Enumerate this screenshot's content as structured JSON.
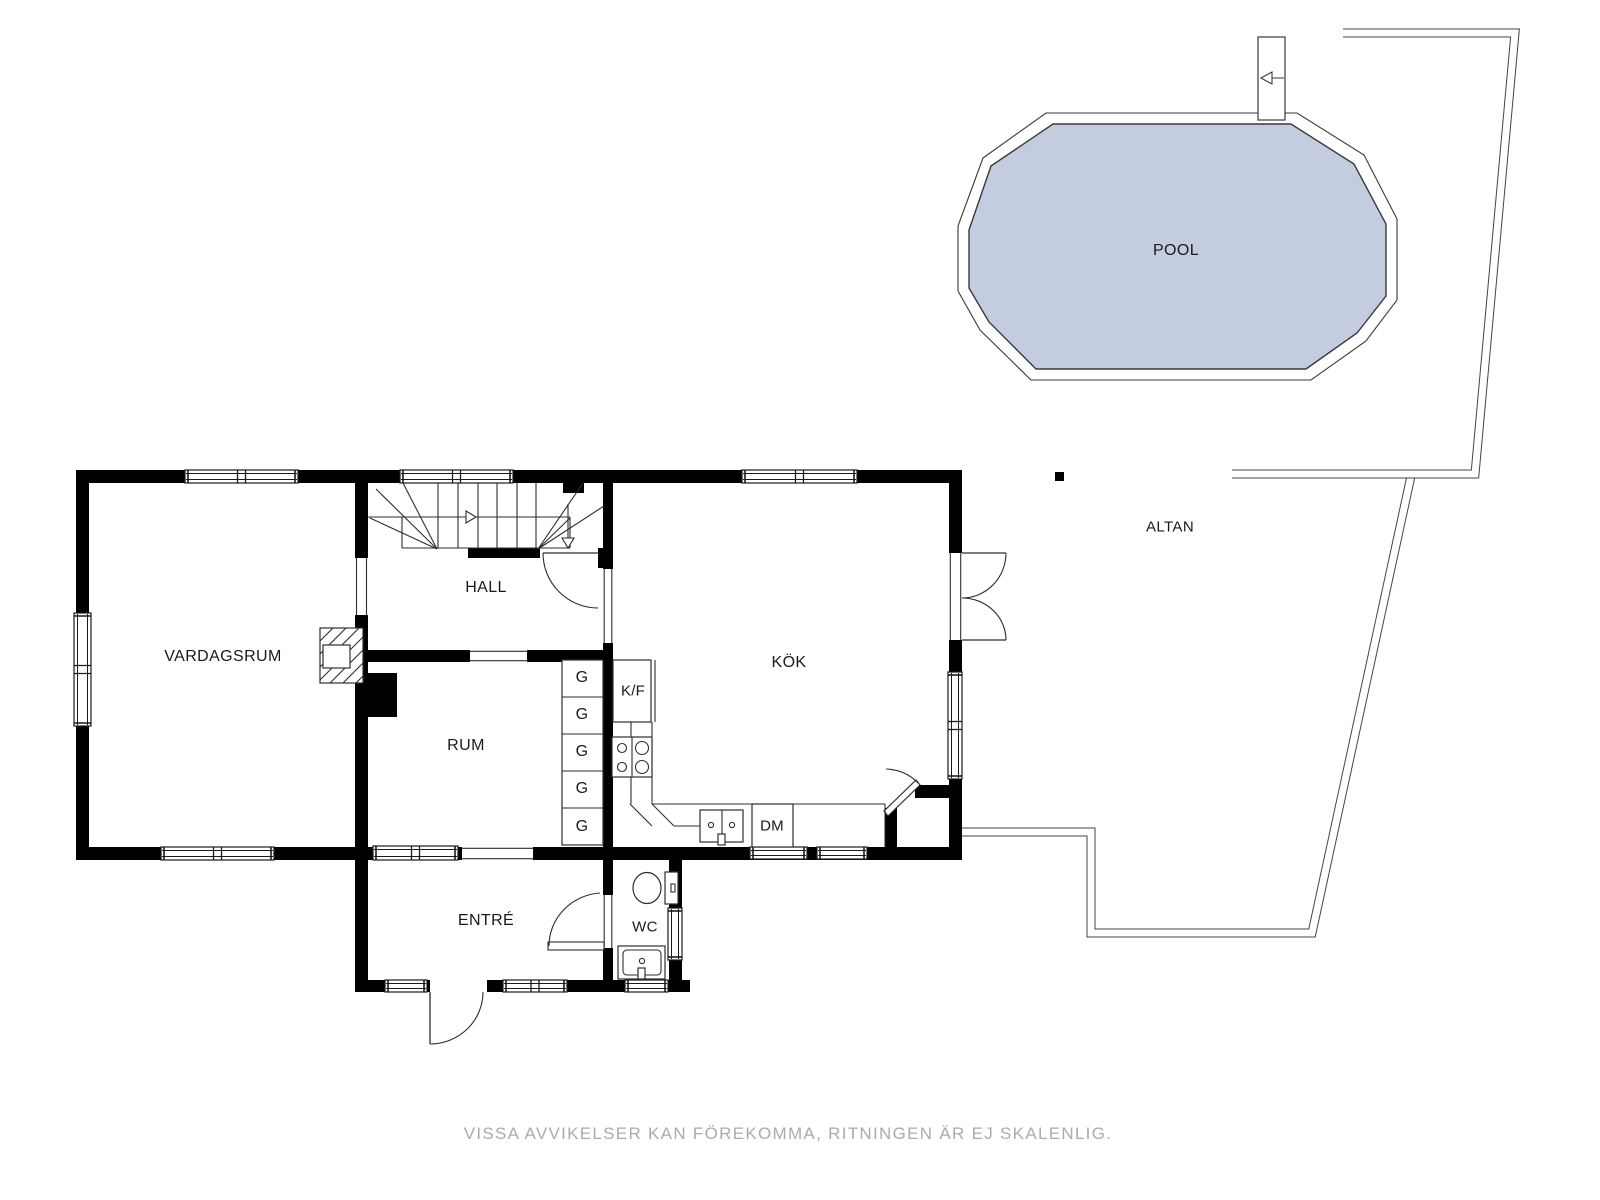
{
  "rooms": {
    "vardagsrum": "VARDAGSRUM",
    "hall": "HALL",
    "rum": "RUM",
    "kok": "KÖK",
    "entre": "ENTRÉ",
    "wc": "WC"
  },
  "outdoor": {
    "altan": "ALTAN",
    "pool": "POOL"
  },
  "fixtures": {
    "wardrobe": "G",
    "fridge_freezer": "K/F",
    "dishwasher": "DM"
  },
  "footer": {
    "disclaimer": "VISSA AVVIKELSER KAN FÖREKOMMA, RITNINGEN ÄR EJ SKALENLIG."
  },
  "colors": {
    "pool_water": "#c4cce0",
    "walls": "#000000",
    "thin_lines": "#2e2e2e",
    "disclaimer_text": "#ababab"
  }
}
